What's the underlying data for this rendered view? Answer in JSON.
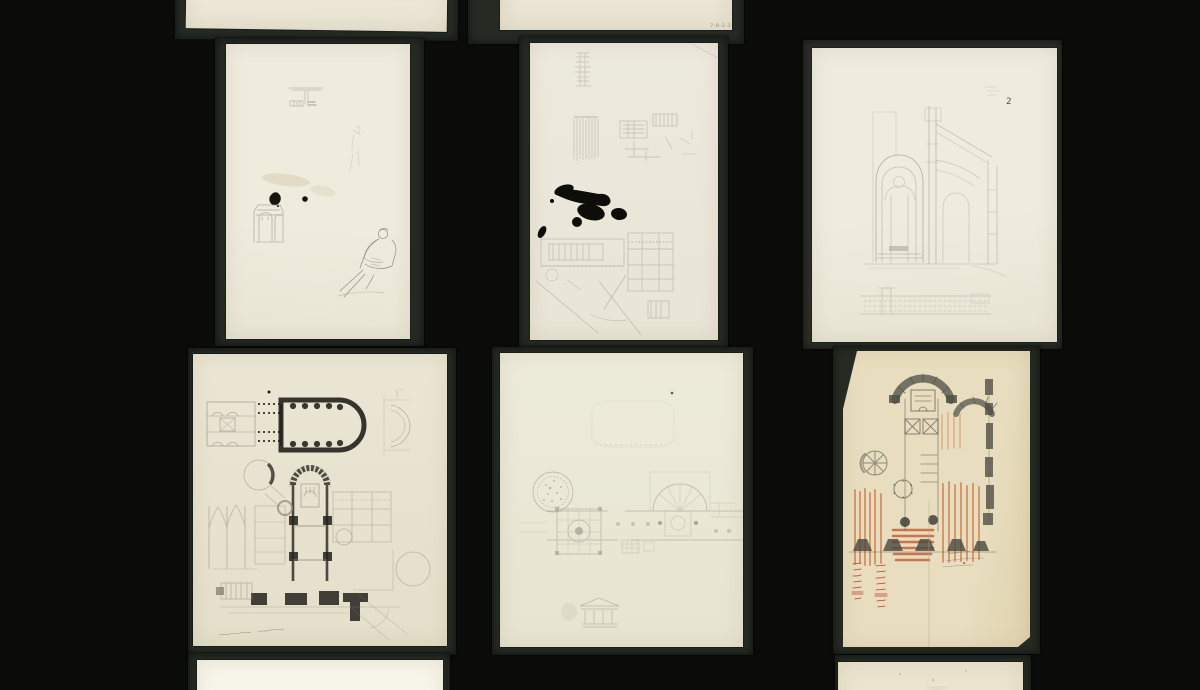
{
  "canvas": {
    "background": "#0b0b09",
    "mount_color": "#252a23"
  },
  "colors": {
    "pencil": "#8f8d83",
    "dark_poche": "#1c1b16",
    "ink": "#0d0d0a",
    "red_chalk": "#c8713e",
    "red_ink": "#bf4630",
    "paper_cream": "#ece8d9",
    "paper_tan": "#e6dbbd"
  },
  "inscriptions": {
    "code_top_center": "7-8-2-3",
    "section_number": "2"
  },
  "sheets": [
    {
      "id": "top-left",
      "alt": "blank cream sheet, cropped at top edge"
    },
    {
      "id": "top-center",
      "alt": "blank sheet with faint pencil code at lower right, cropped at top edge"
    },
    {
      "id": "mid-left",
      "alt": "sketch sheet: beam detail, arched portal, ink spots and seated figure"
    },
    {
      "id": "mid-center",
      "alt": "sketch sheet: building studies and site plan with large black ink blot"
    },
    {
      "id": "mid-right",
      "alt": "church transverse section with gothic window, facade elevation below, numbered 2"
    },
    {
      "id": "bottom-left",
      "alt": "church floor plans with dark poche walls and handwritten caption"
    },
    {
      "id": "bottom-center",
      "alt": "faint horizontal plan with round stamp sketch and small temple portico"
    },
    {
      "id": "bottom-right",
      "alt": "church plan in pencil and red chalk with red tally notes and fold line"
    },
    {
      "id": "lower-left",
      "alt": "blank white sheet, cropped at bottom edge"
    },
    {
      "id": "lower-right",
      "alt": "blank cream sheet, cropped at bottom edge"
    }
  ]
}
